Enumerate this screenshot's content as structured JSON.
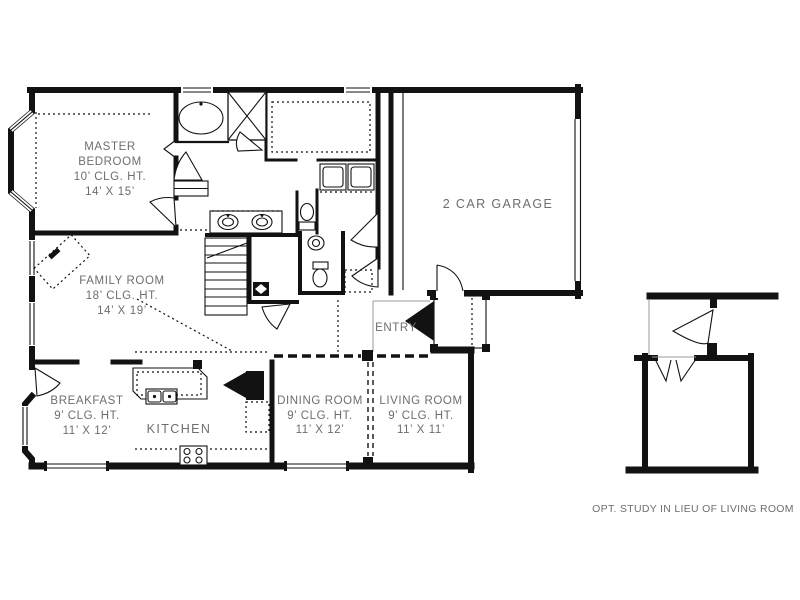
{
  "colors": {
    "wall": "#121212",
    "label": "#6e6e6e",
    "background": "#ffffff"
  },
  "rooms": {
    "master_bedroom": {
      "line1": "MASTER",
      "line2": "BEDROOM",
      "ceiling": "10’ CLG. HT.",
      "size": "14’ X 15’"
    },
    "family_room": {
      "name": "FAMILY ROOM",
      "ceiling": "18’ CLG. HT.",
      "size": "14’ X 19’"
    },
    "breakfast": {
      "name": "BREAKFAST",
      "ceiling": "9’ CLG. HT.",
      "size": "11’ X 12’"
    },
    "kitchen": {
      "name": "KITCHEN"
    },
    "dining_room": {
      "name": "DINING ROOM",
      "ceiling": "9’ CLG. HT.",
      "size": "11’ X 12’"
    },
    "living_room": {
      "name": "LIVING ROOM",
      "ceiling": "9’ CLG. HT.",
      "size": "11’ X 11’"
    },
    "garage": {
      "name": "2 CAR GARAGE"
    },
    "entry": {
      "name": "ENTRY"
    }
  },
  "inset": {
    "caption": "OPT. STUDY IN LIEU OF LIVING ROOM"
  }
}
